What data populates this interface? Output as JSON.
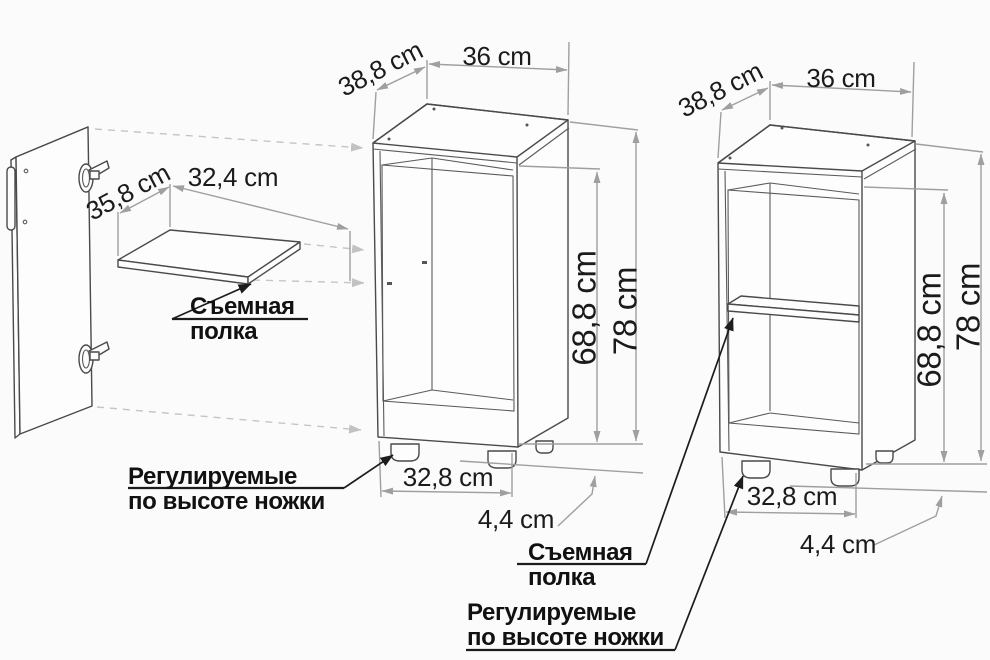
{
  "figure": {
    "type": "furniture-dimension-diagram",
    "callouts": {
      "removable_shelf": {
        "line1": "Съемная",
        "line2": "полка"
      },
      "adjustable_feet": {
        "line1": "Регулируемые",
        "line2": "по высоте ножки"
      }
    },
    "shelf": {
      "depth": "35,8 cm",
      "width": "32,4 cm"
    },
    "cabinet_open": {
      "depth": "38,8 cm",
      "width": "36 cm",
      "inner_height": "68,8 cm",
      "height": "78 cm",
      "base_width": "32,8 cm",
      "feet_height": "4,4 cm"
    },
    "cabinet_assembled": {
      "depth": "38,8 cm",
      "width": "36 cm",
      "inner_height": "68,8 cm",
      "height": "78 cm",
      "base_width": "32,8 cm",
      "feet_height": "4,4 cm"
    },
    "colors": {
      "background": "#fbfbfb",
      "line": "#4a4a4a",
      "dimension": "#9f9f9f",
      "projection": "#c5c5c5",
      "text": "#1b1b1b"
    }
  }
}
